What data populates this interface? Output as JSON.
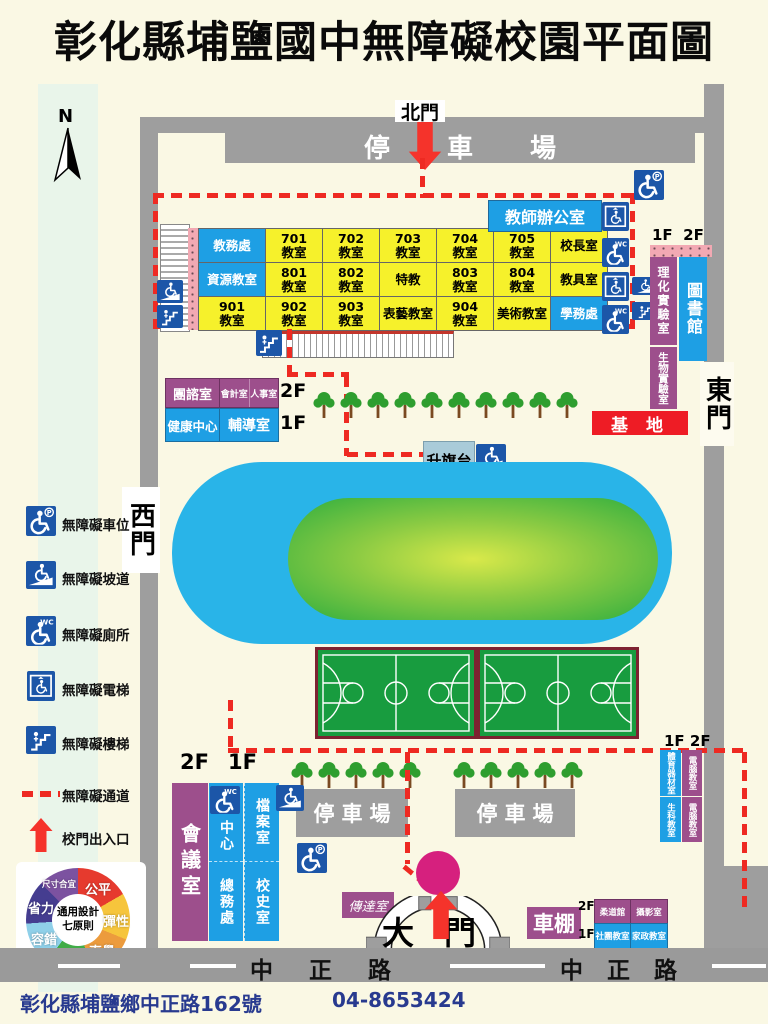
{
  "title": "彰化縣埔鹽國中無障礙校園平面圖",
  "compass": {
    "north_label": "N"
  },
  "gates": {
    "north": "北門",
    "east": "東門",
    "west": "西門",
    "main": "大門"
  },
  "road_name": "中 正 路",
  "parking_lots": {
    "north": "停 車 場",
    "southwest": "停車場",
    "southeast": "停車場"
  },
  "floors": {
    "f1": "1F",
    "f2": "2F"
  },
  "classroom_block": {
    "teacher_office": "教師辦公室",
    "rows": [
      [
        "教務處",
        "701\n教室",
        "702\n教室",
        "703\n教室",
        "704\n教室",
        "705\n教室",
        "校長室"
      ],
      [
        "資源教室",
        "801\n教室",
        "802\n教室",
        "特教",
        "803\n教室",
        "804\n教室",
        "教具室"
      ],
      [
        "901\n教室",
        "902\n教室",
        "903\n教室",
        "表藝教室",
        "904\n教室",
        "美術教室",
        "學務處"
      ]
    ]
  },
  "east_wing": {
    "science_lab": "理化實驗室",
    "library": "圖書館",
    "biology_lab": "生物實驗室",
    "base": "基  地"
  },
  "admin_block": {
    "rooms_2f": [
      "團諮室",
      "會計室",
      "人事室"
    ],
    "rooms_1f": [
      "健康中心",
      "輔導室"
    ]
  },
  "flag_platform": "升旗台",
  "southwest_building": {
    "meeting_room": "會議室",
    "center_room": "中心",
    "general_affairs": "總務處",
    "archives_room": "檔案室",
    "history_room": "校史室"
  },
  "gatehouse": "傳達室",
  "bike_shed": "車棚",
  "southeast_block": {
    "rooms_2f": [
      "柔道館",
      "攝影室"
    ],
    "rooms_1f": [
      "社團教室",
      "家政教室"
    ]
  },
  "east_block": {
    "rooms_1f": [
      "體育器材室",
      "生科教室"
    ],
    "rooms_2f": [
      "電腦教室",
      "電腦教室"
    ]
  },
  "legend": {
    "items": [
      {
        "icon": "accessible-parking-icon",
        "label": "無障礙車位"
      },
      {
        "icon": "accessible-ramp-icon",
        "label": "無障礙坡道"
      },
      {
        "icon": "accessible-toilet-icon",
        "label": "無障礙廁所"
      },
      {
        "icon": "accessible-elevator-icon",
        "label": "無障礙電梯"
      },
      {
        "icon": "accessible-stairs-icon",
        "label": "無障礙樓梯"
      },
      {
        "icon": "accessible-path-dashed-line",
        "label": "無障礙通道"
      },
      {
        "icon": "gate-entrance-arrow",
        "label": "校門出入口"
      }
    ]
  },
  "ud_wheel": {
    "center_label": "通用設計\n七原則",
    "segments": [
      {
        "label": "公平",
        "color": "#E63A2E"
      },
      {
        "label": "彈性",
        "color": "#F6C53C"
      },
      {
        "label": "直覺",
        "color": "#EC9B3D"
      },
      {
        "label": "易讀",
        "color": "#41AC48"
      },
      {
        "label": "容錯",
        "color": "#8FD0E9"
      },
      {
        "label": "省力",
        "color": "#453D90"
      },
      {
        "label": "尺寸合宜",
        "color": "#7C52A0"
      }
    ]
  },
  "footer": {
    "address": "彰化縣埔鹽鄉中正路162號",
    "phone": "04-8653424"
  },
  "colors": {
    "path_red": "#EE2A22",
    "room_blue": "#1E9FE4",
    "room_yellow": "#F6F12B",
    "room_purple": "#9D4F8C",
    "track_blue": "#29B4E8",
    "infield_green": "#2FAE3F",
    "court_green": "#189C3F",
    "icon_blue": "#1C56A8",
    "entry_magenta": "#D6207E",
    "base_red": "#EE1C25",
    "road_gray": "#9A9A9A"
  }
}
